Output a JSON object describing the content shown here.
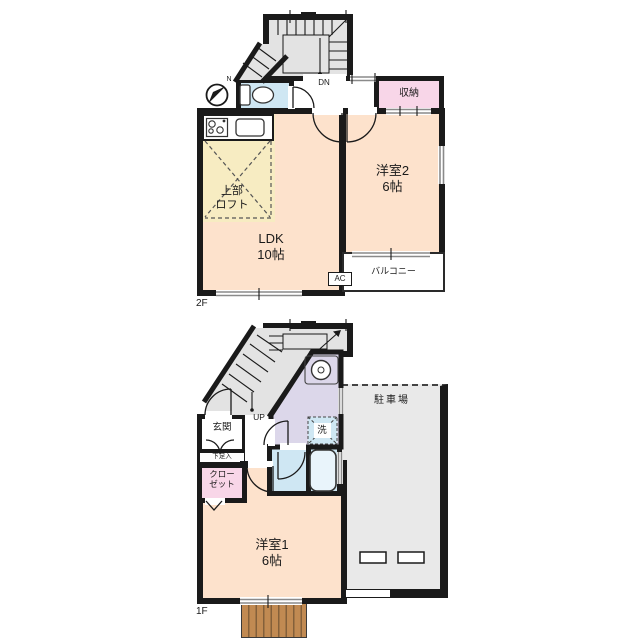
{
  "floor2": {
    "floor_label": "2F",
    "dn": "DN",
    "compass_north": "N",
    "storage": "収納",
    "room2_name": "洋室2",
    "room2_size": "6帖",
    "ldk_name": "LDK",
    "ldk_size": "10帖",
    "loft_line1": "上部",
    "loft_line2": "ロフト",
    "balcony": "バルコニー",
    "ac": "AC"
  },
  "floor1": {
    "floor_label": "1F",
    "up": "UP",
    "entrance": "玄関",
    "shoe_box": "下足入",
    "closet_line1": "クロー",
    "closet_line2": "ゼット",
    "laundry": "洗",
    "parking": "駐車場",
    "room1_name": "洋室1",
    "room1_size": "6帖"
  },
  "colors": {
    "wall": "#1a1a1a",
    "room_peach": "#fde2cc",
    "kitchen_yellow": "#f7ecc2",
    "storage_pink": "#f8d6e8",
    "water_blue": "#cfe7f3",
    "washroom_lavender": "#dcd7ea",
    "stair_gray": "#e3e3e3",
    "parking_gray": "#e9e9e9",
    "deck_brown": "#c18a52",
    "window_gray": "#8a8a8a"
  }
}
